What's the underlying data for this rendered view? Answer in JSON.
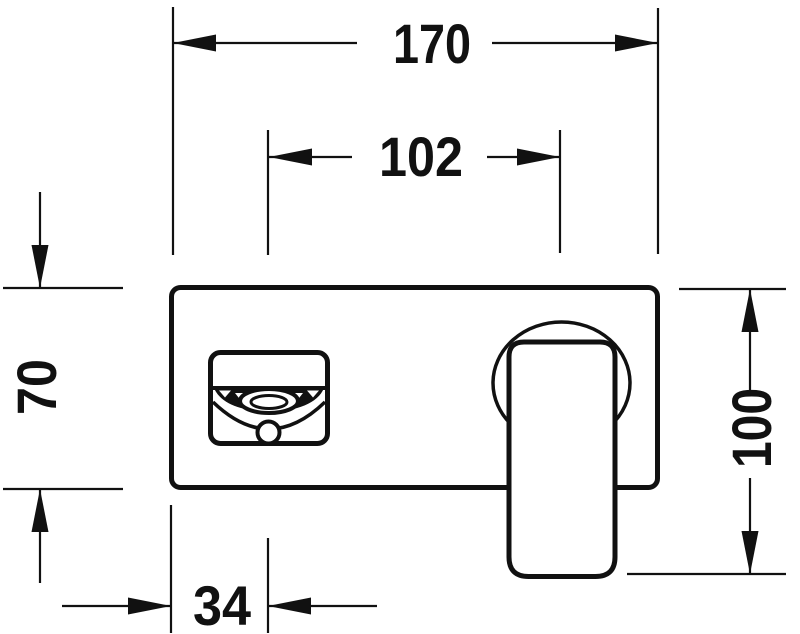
{
  "drawing": {
    "colors": {
      "line": "#111111",
      "background": "#ffffff"
    },
    "fixture": {
      "parts": [
        "escutcheon-plate",
        "spout-front-view",
        "aerator",
        "handle-base",
        "lever-handle"
      ]
    },
    "dimensions": {
      "overall_width": {
        "label": "170",
        "orientation": "horizontal"
      },
      "spout_to_handle": {
        "label": "102",
        "orientation": "horizontal"
      },
      "plate_height": {
        "label": "70",
        "orientation": "vertical"
      },
      "overall_height": {
        "label": "100",
        "orientation": "vertical"
      },
      "edge_to_spout": {
        "label": "34",
        "orientation": "horizontal"
      }
    }
  }
}
